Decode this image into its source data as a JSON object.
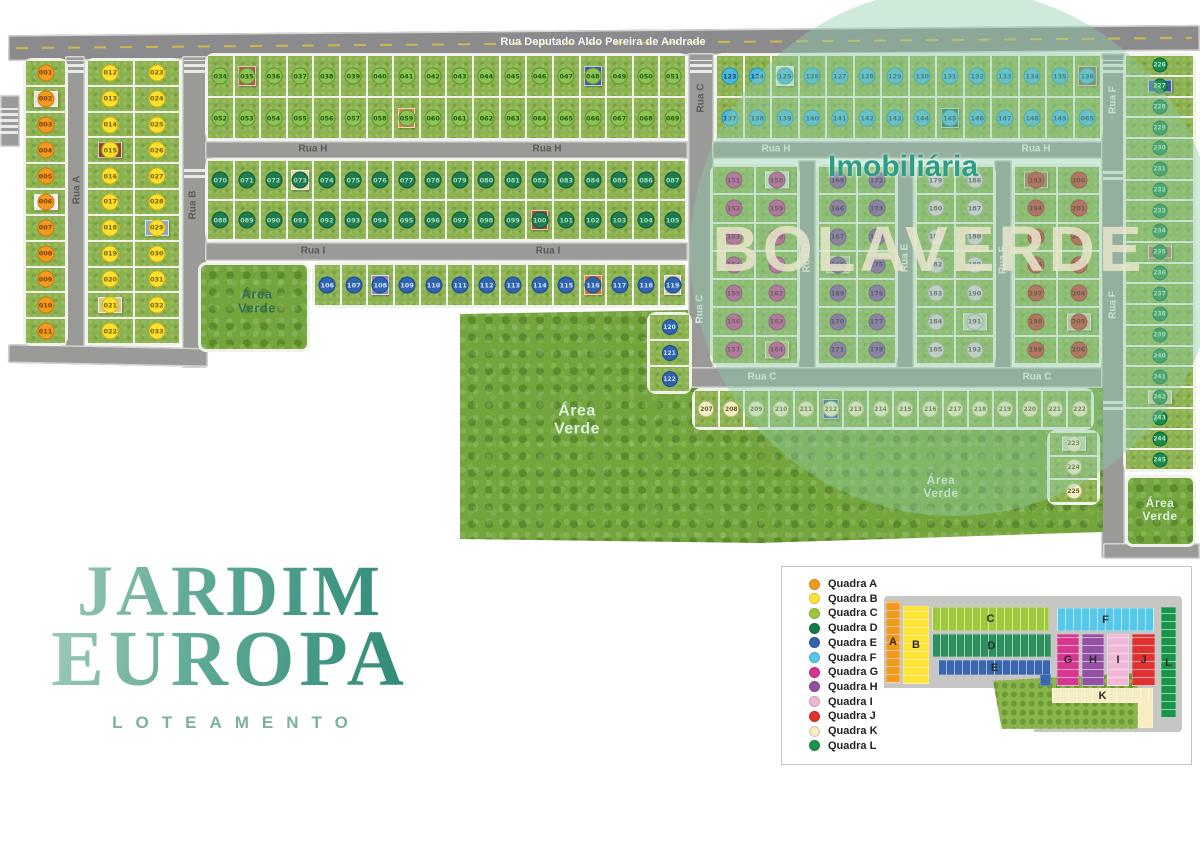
{
  "watermark": {
    "line1": "Imobiliária",
    "brand": "BOLAVERDE"
  },
  "logo": {
    "word1": "JARDIM",
    "word2": "EUROPA",
    "subtitle": "LOTEAMENTO"
  },
  "street_labels": [
    {
      "text": "Rua Deputado Aldo Pereira de Andrade",
      "x": 603,
      "y": 42,
      "rot": 0,
      "tone": "white",
      "size": 11
    },
    {
      "text": "Rua A",
      "x": 77,
      "y": 190,
      "rot": -90,
      "tone": "dark",
      "size": 10
    },
    {
      "text": "Rua B",
      "x": 193,
      "y": 205,
      "rot": -90,
      "tone": "dark",
      "size": 10
    },
    {
      "text": "Rua H",
      "x": 313,
      "y": 149,
      "rot": 0,
      "tone": "dark",
      "size": 10
    },
    {
      "text": "Rua H",
      "x": 547,
      "y": 149,
      "rot": 0,
      "tone": "dark",
      "size": 10
    },
    {
      "text": "Rua I",
      "x": 313,
      "y": 251,
      "rot": 0,
      "tone": "dark",
      "size": 10
    },
    {
      "text": "Rua I",
      "x": 548,
      "y": 251,
      "rot": 0,
      "tone": "dark",
      "size": 10
    },
    {
      "text": "Rua C",
      "x": 701,
      "y": 98,
      "rot": -90,
      "tone": "dark",
      "size": 10
    },
    {
      "text": "Rua C",
      "x": 700,
      "y": 309,
      "rot": -90,
      "tone": "light",
      "size": 10
    },
    {
      "text": "Rua H",
      "x": 776,
      "y": 149,
      "rot": 0,
      "tone": "light",
      "size": 10
    },
    {
      "text": "Rua H",
      "x": 1036,
      "y": 149,
      "rot": 0,
      "tone": "light",
      "size": 10
    },
    {
      "text": "Rua D",
      "x": 807,
      "y": 258,
      "rot": -90,
      "tone": "light",
      "size": 10
    },
    {
      "text": "Rua E",
      "x": 905,
      "y": 258,
      "rot": -90,
      "tone": "light",
      "size": 10
    },
    {
      "text": "Rua F",
      "x": 1003,
      "y": 260,
      "rot": -90,
      "tone": "light",
      "size": 10
    },
    {
      "text": "Rua F",
      "x": 1113,
      "y": 100,
      "rot": -90,
      "tone": "light",
      "size": 10
    },
    {
      "text": "Rua F",
      "x": 1113,
      "y": 305,
      "rot": -90,
      "tone": "light",
      "size": 10
    },
    {
      "text": "Rua C",
      "x": 762,
      "y": 377,
      "rot": 0,
      "tone": "light",
      "size": 10
    },
    {
      "text": "Rua C",
      "x": 1037,
      "y": 377,
      "rot": 0,
      "tone": "light",
      "size": 10
    }
  ],
  "green_labels": [
    {
      "text": "Área Verde",
      "x": 257,
      "y": 302,
      "tone": "dark",
      "size": 13
    },
    {
      "text": "Área Verde",
      "x": 577,
      "y": 420,
      "tone": "light",
      "size": 16
    },
    {
      "text": "Área Verde",
      "x": 941,
      "y": 487,
      "tone": "light",
      "size": 12
    },
    {
      "text": "Área Verde",
      "x": 1160,
      "y": 510,
      "tone": "light",
      "size": 12
    }
  ],
  "quadra_colors": {
    "A": {
      "bg": "#f39b1f",
      "border": "#c9790e",
      "text": "#7c3c00"
    },
    "B": {
      "bg": "#ffe02e",
      "border": "#d2b214",
      "text": "#6f5f00"
    },
    "C": {
      "bg": "#8fc353",
      "border": "#5d9431",
      "text": "#1d5c12"
    },
    "D": {
      "bg": "#1f7b50",
      "border": "#135a38",
      "text": "#a7dcb6"
    },
    "E": {
      "bg": "#2f63ad",
      "border": "#1c4a8c",
      "text": "#d6e4ff"
    },
    "F": {
      "bg": "#4db9d8",
      "border": "#2a92b5",
      "text": "#134a78"
    },
    "G": {
      "bg": "#c83f92",
      "border": "#97216a",
      "text": "#5c0f3e"
    },
    "H": {
      "bg": "#8a4f9e",
      "border": "#663277",
      "text": "#2e1245"
    },
    "I": {
      "bg": "#e2d0da",
      "border": "#b49cab",
      "text": "#4f4650"
    },
    "J": {
      "bg": "#cc3a34",
      "border": "#9c211c",
      "text": "#4f0b08"
    },
    "K": {
      "bg": "#f4eecb",
      "border": "#cfc08a",
      "text": "#6b5b1e"
    },
    "L": {
      "bg": "#1b8a50",
      "border": "#0f6337",
      "text": "#aee3bd"
    }
  },
  "blocks": [
    {
      "id": "A",
      "quadra": "A",
      "rows": [
        [
          "001"
        ],
        [
          "002"
        ],
        [
          "003"
        ],
        [
          "004"
        ],
        [
          "005"
        ],
        [
          "006"
        ],
        [
          "007"
        ],
        [
          "008"
        ],
        [
          "009"
        ],
        [
          "010"
        ],
        [
          "011"
        ]
      ]
    },
    {
      "id": "B",
      "quadra": "B",
      "rows": [
        [
          "012",
          "023"
        ],
        [
          "013",
          "024"
        ],
        [
          "014",
          "025"
        ],
        [
          "015",
          "026"
        ],
        [
          "016",
          "027"
        ],
        [
          "017",
          "028"
        ],
        [
          "018",
          "029"
        ],
        [
          "019",
          "030"
        ],
        [
          "020",
          "031"
        ],
        [
          "021",
          "032"
        ],
        [
          "022",
          "033"
        ]
      ]
    },
    {
      "id": "C",
      "quadra": "C",
      "rows": [
        [
          "034",
          "035",
          "036",
          "037",
          "038",
          "039",
          "040",
          "041",
          "042",
          "043",
          "044",
          "045",
          "046",
          "047",
          "048",
          "049",
          "050",
          "051"
        ],
        [
          "052",
          "053",
          "054",
          "055",
          "056",
          "057",
          "058",
          "059",
          "060",
          "061",
          "062",
          "063",
          "064",
          "065",
          "066",
          "067",
          "068",
          "069"
        ]
      ]
    },
    {
      "id": "D",
      "quadra": "D",
      "rows": [
        [
          "070",
          "071",
          "072",
          "073",
          "074",
          "075",
          "076",
          "077",
          "078",
          "079",
          "080",
          "081",
          "082",
          "083",
          "084",
          "085",
          "086",
          "087"
        ],
        [
          "088",
          "089",
          "090",
          "091",
          "092",
          "093",
          "094",
          "095",
          "096",
          "097",
          "098",
          "099",
          "100",
          "101",
          "102",
          "103",
          "104",
          "105"
        ]
      ]
    },
    {
      "id": "E1",
      "quadra": "E",
      "rows": [
        [
          "106",
          "107",
          "108",
          "109",
          "110",
          "111",
          "112",
          "113",
          "114",
          "115",
          "116",
          "117",
          "118",
          "119"
        ]
      ]
    },
    {
      "id": "E2",
      "quadra": "E",
      "rows": [
        [
          "120"
        ],
        [
          "121"
        ],
        [
          "122"
        ]
      ]
    },
    {
      "id": "F",
      "quadra": "F",
      "rows": [
        [
          "123",
          "124",
          "125",
          "126",
          "127",
          "128",
          "129",
          "130",
          "131",
          "132",
          "133",
          "134",
          "135",
          "136"
        ],
        [
          "137",
          "138",
          "139",
          "140",
          "141",
          "142",
          "143",
          "144",
          "145",
          "146",
          "147",
          "148",
          "149",
          "065"
        ]
      ]
    },
    {
      "id": "G",
      "quadra": "G",
      "rows": [
        [
          "151",
          "158"
        ],
        [
          "152",
          "159"
        ],
        [
          "153",
          "160"
        ],
        [
          "154",
          "161"
        ],
        [
          "155",
          "162"
        ],
        [
          "156",
          "163"
        ],
        [
          "157",
          "164"
        ]
      ]
    },
    {
      "id": "H",
      "quadra": "H",
      "rows": [
        [
          "165",
          "172"
        ],
        [
          "166",
          "173"
        ],
        [
          "167",
          "174"
        ],
        [
          "168",
          "175"
        ],
        [
          "169",
          "176"
        ],
        [
          "170",
          "177"
        ],
        [
          "171",
          "178"
        ]
      ]
    },
    {
      "id": "I",
      "quadra": "I",
      "rows": [
        [
          "179",
          "186"
        ],
        [
          "180",
          "187"
        ],
        [
          "181",
          "188"
        ],
        [
          "182",
          "189"
        ],
        [
          "183",
          "190"
        ],
        [
          "184",
          "191"
        ],
        [
          "185",
          "192"
        ]
      ]
    },
    {
      "id": "J",
      "quadra": "J",
      "rows": [
        [
          "193",
          "200"
        ],
        [
          "194",
          "201"
        ],
        [
          "195",
          "202"
        ],
        [
          "196",
          "203"
        ],
        [
          "197",
          "204"
        ],
        [
          "198",
          "205"
        ],
        [
          "199",
          "206"
        ]
      ]
    },
    {
      "id": "K1",
      "quadra": "K",
      "rows": [
        [
          "207",
          "208",
          "209",
          "210",
          "211",
          "212",
          "213",
          "214",
          "215",
          "216",
          "217",
          "218",
          "219",
          "220",
          "221",
          "222"
        ]
      ]
    },
    {
      "id": "K2",
      "quadra": "K",
      "rows": [
        [
          "223"
        ],
        [
          "224"
        ],
        [
          "225"
        ]
      ]
    },
    {
      "id": "L",
      "quadra": "L",
      "rows": [
        [
          "226"
        ],
        [
          "227"
        ],
        [
          "228"
        ],
        [
          "229"
        ],
        [
          "230"
        ],
        [
          "231"
        ],
        [
          "232"
        ],
        [
          "233"
        ],
        [
          "234"
        ],
        [
          "235"
        ],
        [
          "236"
        ],
        [
          "237"
        ],
        [
          "238"
        ],
        [
          "239"
        ],
        [
          "240"
        ],
        [
          "241"
        ],
        [
          "242"
        ],
        [
          "243"
        ],
        [
          "244"
        ],
        [
          "245"
        ]
      ]
    }
  ],
  "houses": {
    "002": "#e9e6d8",
    "006": "#f0f1ec",
    "015": "#8a4a2e",
    "021": "#d9c79c",
    "029": "#8fa6c4",
    "035": "#b2593d",
    "048": "#3a5aa8",
    "059": "#d8823f",
    "073": "#e7d9b2",
    "100": "#a84a32",
    "108": "#9a83b8",
    "116": "#d8732e",
    "119": "#ddd0ae",
    "125": "#d9ecdc",
    "136": "#96603c",
    "145": "#20714e",
    "158": "#cfe0c2",
    "164": "#c0b070",
    "168": "#a8b890",
    "191": "#c2d6ae",
    "193": "#a87448",
    "205": "#cfc09e",
    "212": "#3a5aa8",
    "223": "#ccd6c4",
    "227": "#3a5aa8",
    "235": "#b87060",
    "242": "#d6c49c"
  },
  "legend": {
    "items": [
      {
        "label": "Quadra A",
        "color": "#f5981e"
      },
      {
        "label": "Quadra B",
        "color": "#ffe435"
      },
      {
        "label": "Quadra C",
        "color": "#9dc93b"
      },
      {
        "label": "Quadra D",
        "color": "#17784a"
      },
      {
        "label": "Quadra E",
        "color": "#2f63ad"
      },
      {
        "label": "Quadra F",
        "color": "#56c8ea"
      },
      {
        "label": "Quadra G",
        "color": "#d6368f"
      },
      {
        "label": "Quadra H",
        "color": "#9350a4"
      },
      {
        "label": "Quadra I",
        "color": "#f0b8d6"
      },
      {
        "label": "Quadra J",
        "color": "#e03030"
      },
      {
        "label": "Quadra K",
        "color": "#f7ecc2"
      },
      {
        "label": "Quadra L",
        "color": "#18954a"
      }
    ]
  },
  "minimap": {
    "blocks": [
      {
        "letter": "A",
        "color": "#f5981e",
        "x": 886,
        "y": 601,
        "w": 14,
        "h": 82
      },
      {
        "letter": "B",
        "color": "#ffe435",
        "x": 903,
        "y": 606,
        "w": 26,
        "h": 78
      },
      {
        "letter": "C",
        "color": "#9dc93b",
        "x": 932,
        "y": 607,
        "w": 117,
        "h": 24
      },
      {
        "letter": "D",
        "color": "#2e8f5e",
        "x": 932,
        "y": 634,
        "w": 119,
        "h": 23
      },
      {
        "letter": "E",
        "color": "#3a66b0",
        "x": 938,
        "y": 660,
        "w": 113,
        "h": 15
      },
      {
        "letter": "F",
        "color": "#56c8ea",
        "x": 1057,
        "y": 608,
        "w": 97,
        "h": 23
      },
      {
        "letter": "G",
        "color": "#d6368f",
        "x": 1057,
        "y": 634,
        "w": 22,
        "h": 52
      },
      {
        "letter": "H",
        "color": "#9350a4",
        "x": 1082,
        "y": 634,
        "w": 22,
        "h": 52
      },
      {
        "letter": "I",
        "color": "#f0b8d6",
        "x": 1107,
        "y": 634,
        "w": 22,
        "h": 52
      },
      {
        "letter": "J",
        "color": "#e03030",
        "x": 1132,
        "y": 634,
        "w": 23,
        "h": 52
      },
      {
        "letter": "K",
        "color": "#f7ecc2",
        "x": 1052,
        "y": 688,
        "w": 101,
        "h": 15
      },
      {
        "letter": "L",
        "color": "#18954a",
        "x": 1161,
        "y": 607,
        "w": 15,
        "h": 111
      }
    ],
    "extras": [
      {
        "color": "#f7ecc2",
        "x": 1138,
        "y": 702,
        "w": 15,
        "h": 26
      },
      {
        "color": "#3a66b0",
        "x": 1040,
        "y": 674,
        "w": 11,
        "h": 12
      }
    ],
    "forest": {
      "x": 993,
      "y": 673,
      "w": 145,
      "h": 56
    }
  }
}
